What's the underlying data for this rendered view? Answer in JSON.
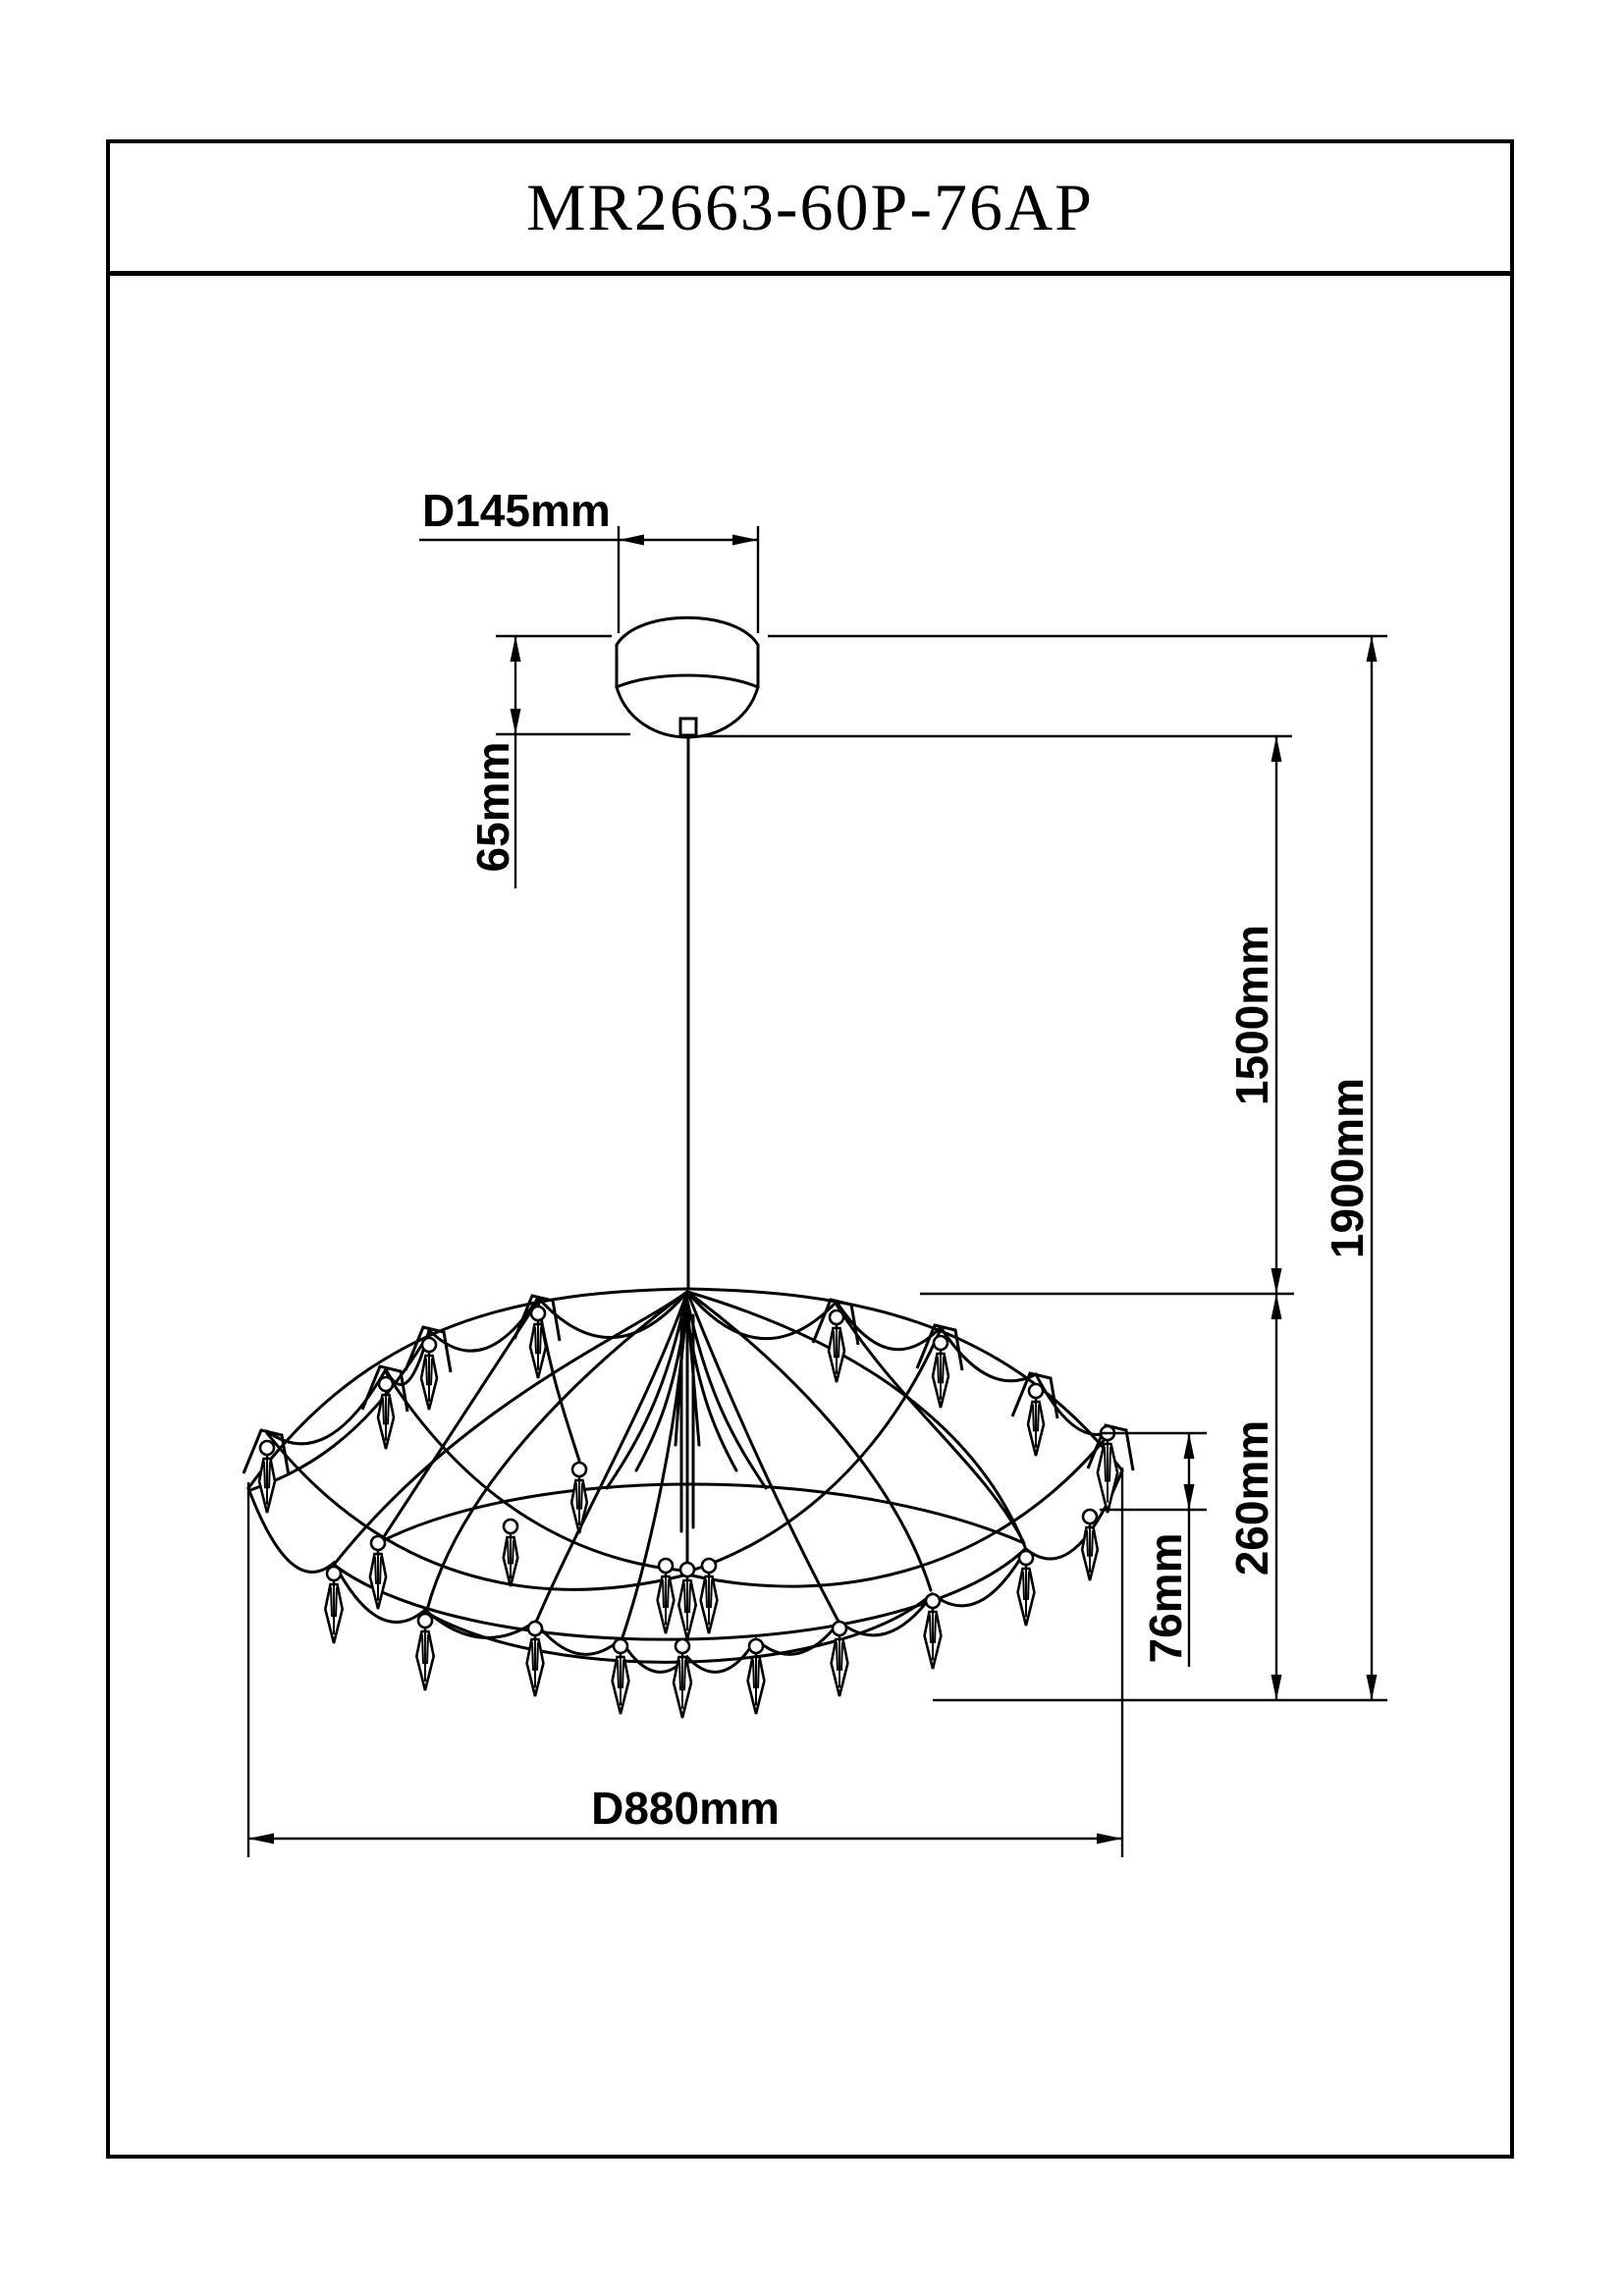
{
  "header": {
    "model": "MR2663-60P-76AP"
  },
  "dimensions": {
    "canopy_diameter": "D145mm",
    "canopy_height": "65mm",
    "suspension_length": "1500mm",
    "overall_drop": "1900mm",
    "fixture_height": "260mm",
    "pendant_drop": "76mm",
    "fixture_diameter": "D880mm"
  },
  "colors": {
    "line": "#000000",
    "background": "#ffffff"
  }
}
